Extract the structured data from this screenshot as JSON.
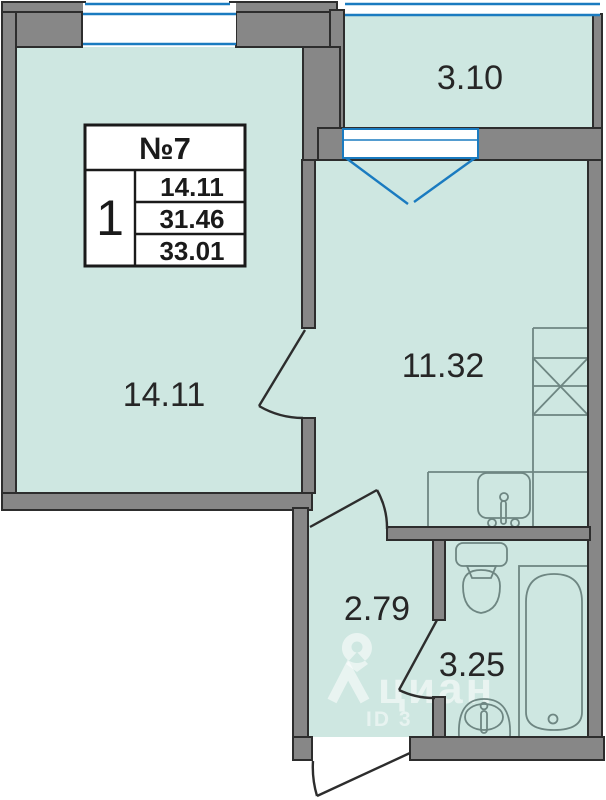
{
  "info_box": {
    "number": "№7",
    "rooms_count": "1",
    "values": [
      "14.11",
      "31.46",
      "33.01"
    ]
  },
  "rooms": {
    "living": "14.11",
    "kitchen": "11.32",
    "balcony": "3.10",
    "hallway": "2.79",
    "bathroom": "3.25"
  },
  "watermark": {
    "brand": "циан",
    "id_label": "ID 3"
  },
  "colors": {
    "floor": "#cee7e1",
    "wall": "#878787",
    "outline": "#2d2d2d",
    "window_blue": "#1a7bc0",
    "fixture": "#6e8682",
    "text": "#262626"
  }
}
